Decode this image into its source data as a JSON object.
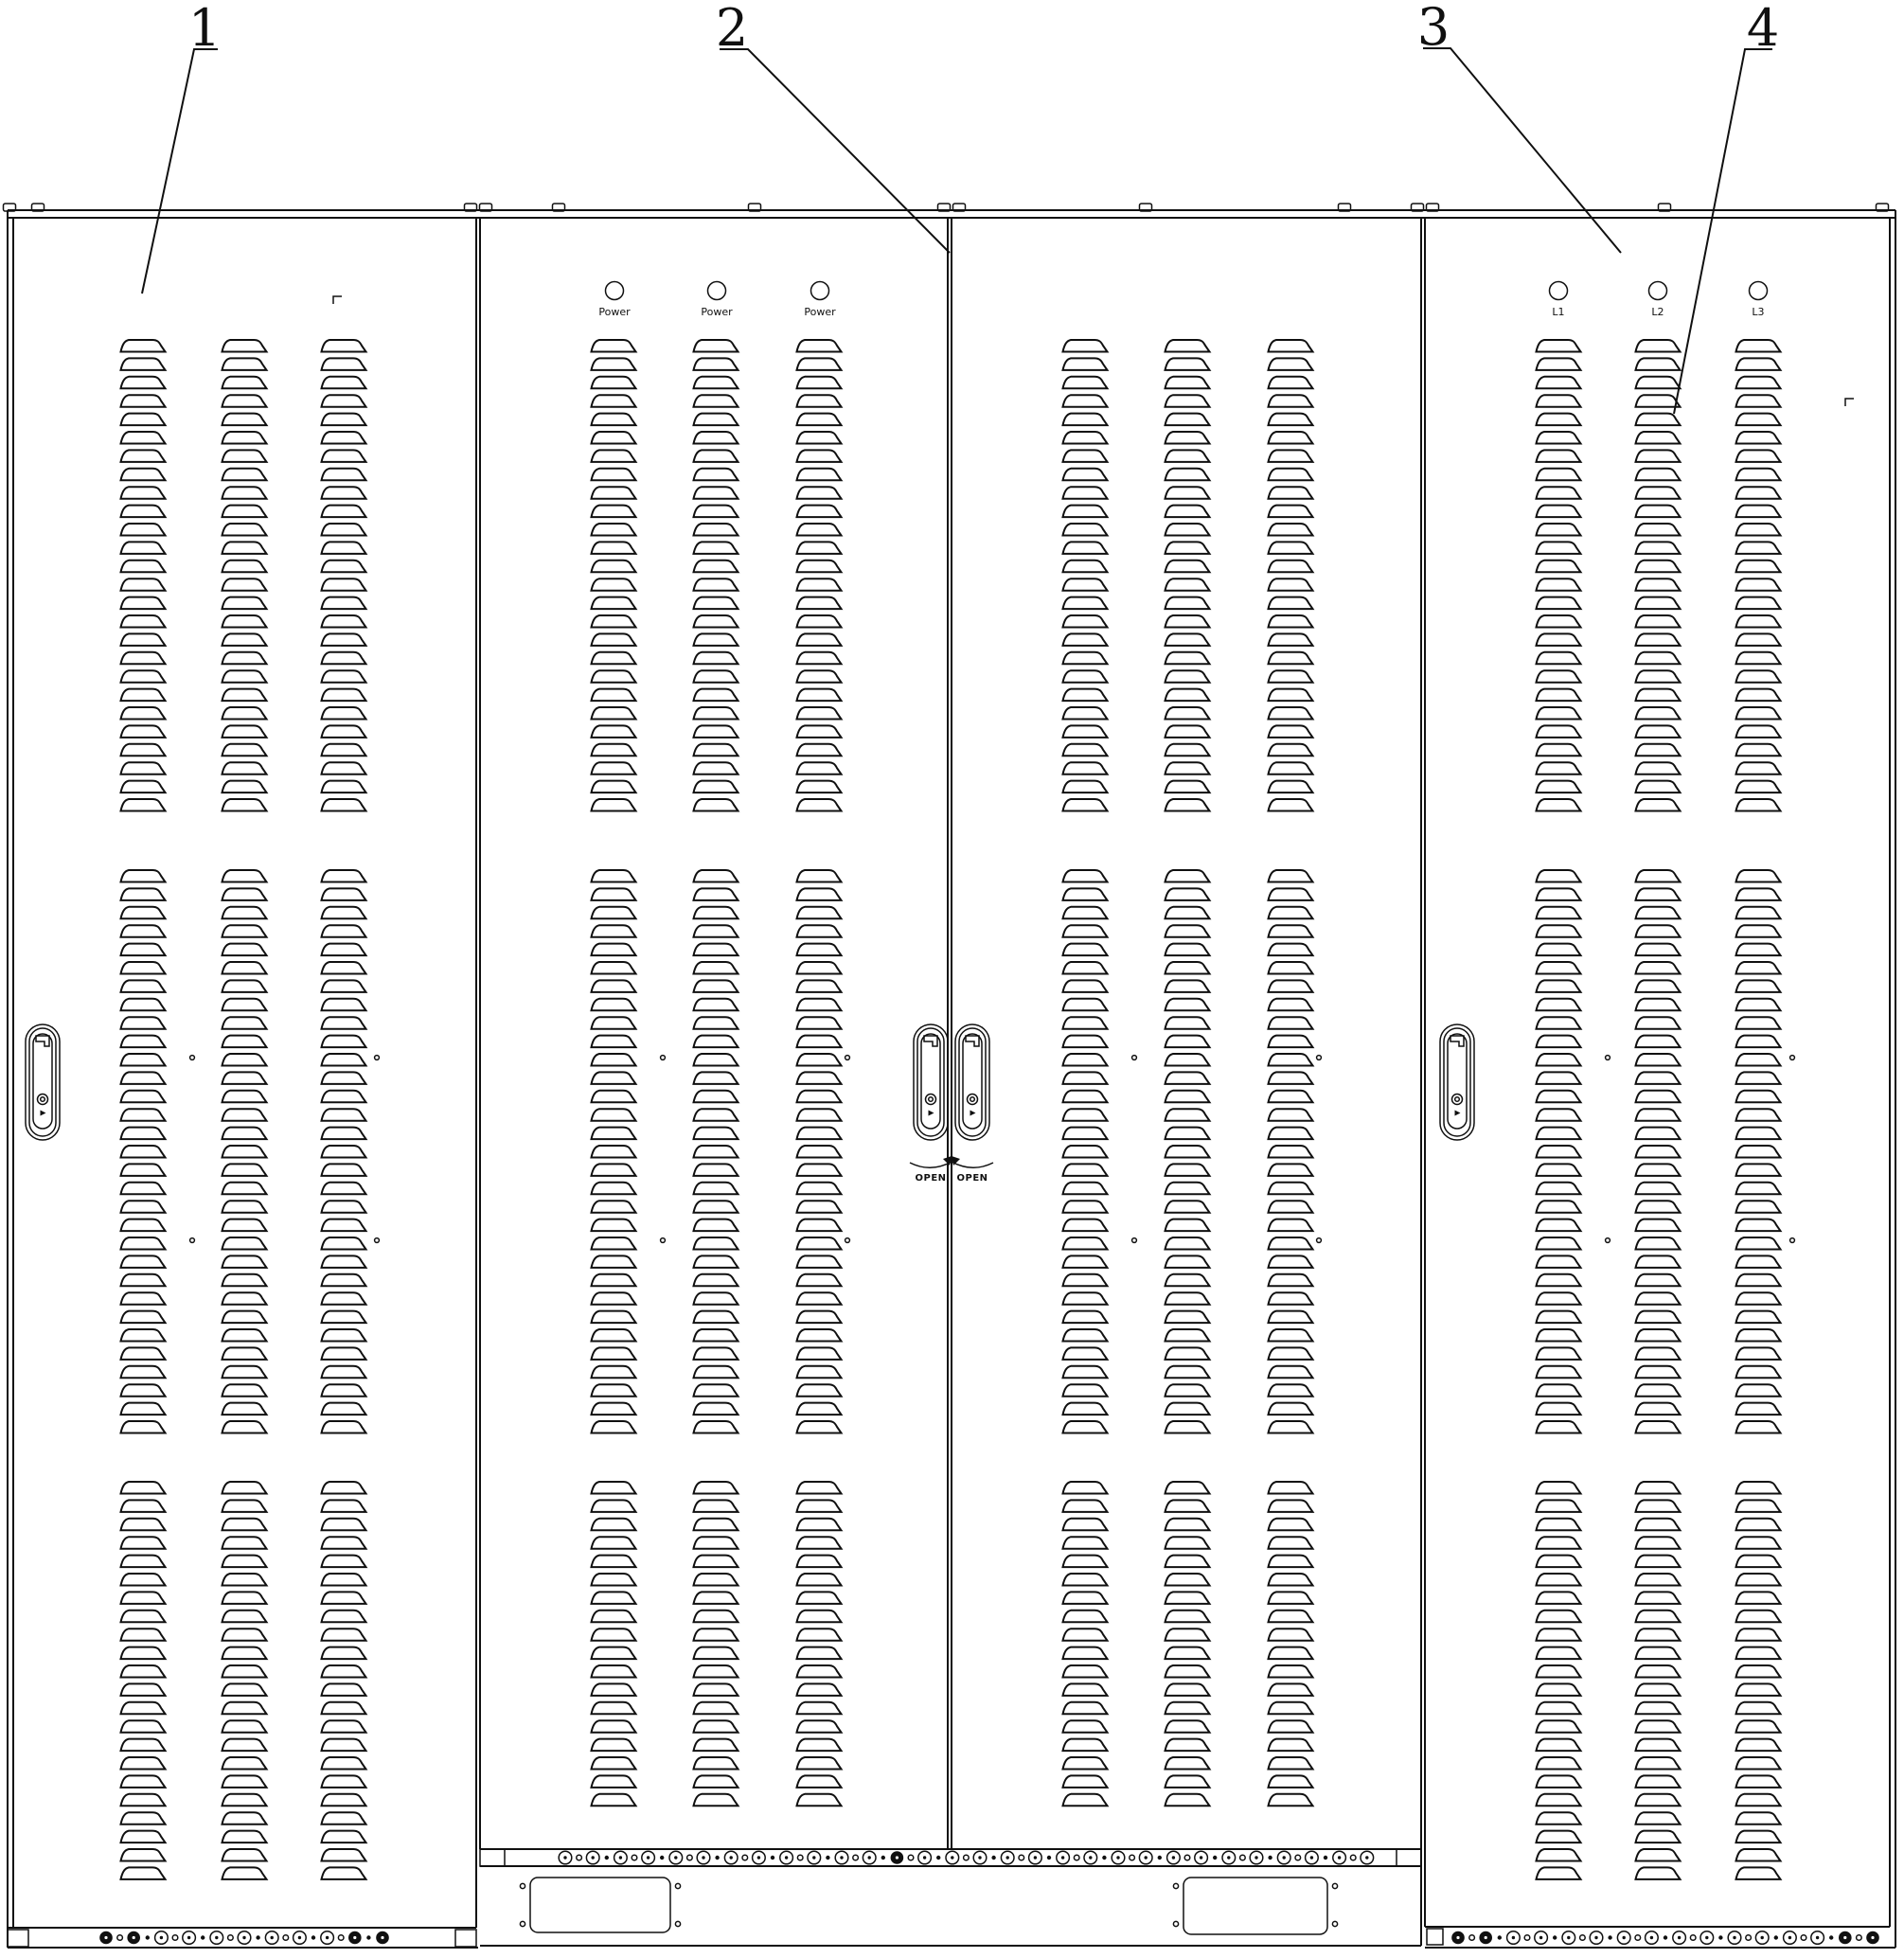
{
  "drawing": {
    "title": "four-cabinet front elevation line drawing",
    "callouts": [
      {
        "label": "1"
      },
      {
        "label": "2"
      },
      {
        "label": "3"
      },
      {
        "label": "4"
      }
    ],
    "cabinet2_indicator_labels": [
      "Power",
      "Power",
      "Power"
    ],
    "cabinet4_indicator_labels": [
      "L1",
      "L2",
      "L3"
    ],
    "handle_open_labels": [
      "OPEN",
      "OPEN"
    ],
    "colors": {
      "line": "#101010",
      "background": "#ffffff"
    }
  }
}
